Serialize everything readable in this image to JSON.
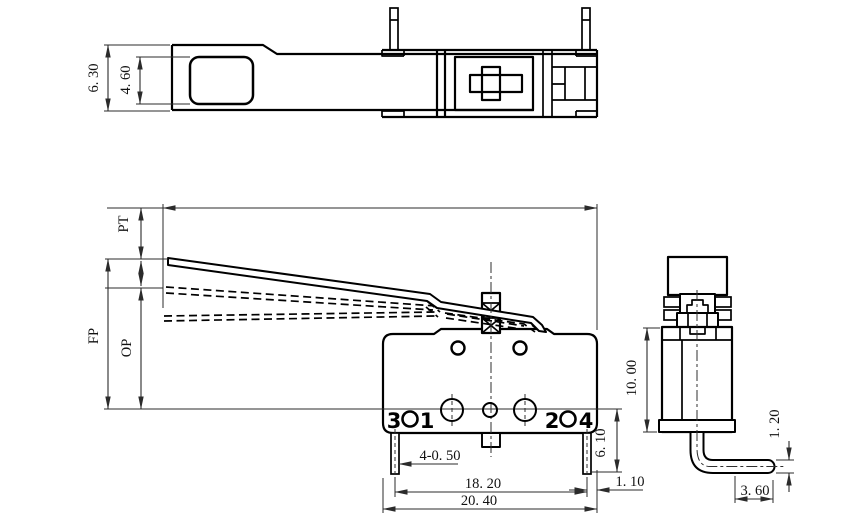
{
  "drawing": {
    "type": "engineering-drawing",
    "subject": "micro switch with hinge lever, three orthographic views",
    "colors": {
      "line": "#000000",
      "dim": "#2b2b2b",
      "background": "#ffffff"
    },
    "top_view": {
      "dim_outer_height": "6. 30",
      "dim_hole_height": "4. 60"
    },
    "front_view": {
      "dim_pretravel": "PT",
      "dim_free_position": "FP",
      "dim_operating_position": "OP",
      "dim_terminal_width": "4-0. 50",
      "dim_terminal_pitch": "18. 20",
      "dim_overall_width": "20. 40",
      "dim_terminal_length": "6. 10",
      "dim_edge_offset": "1. 10",
      "terminal_3": "3",
      "terminal_1": "1",
      "terminal_2": "2",
      "terminal_4": "4"
    },
    "side_view": {
      "dim_body_height": "10. 00",
      "dim_pin_thickness": "1. 20",
      "dim_pin_reach": "3. 60"
    }
  }
}
